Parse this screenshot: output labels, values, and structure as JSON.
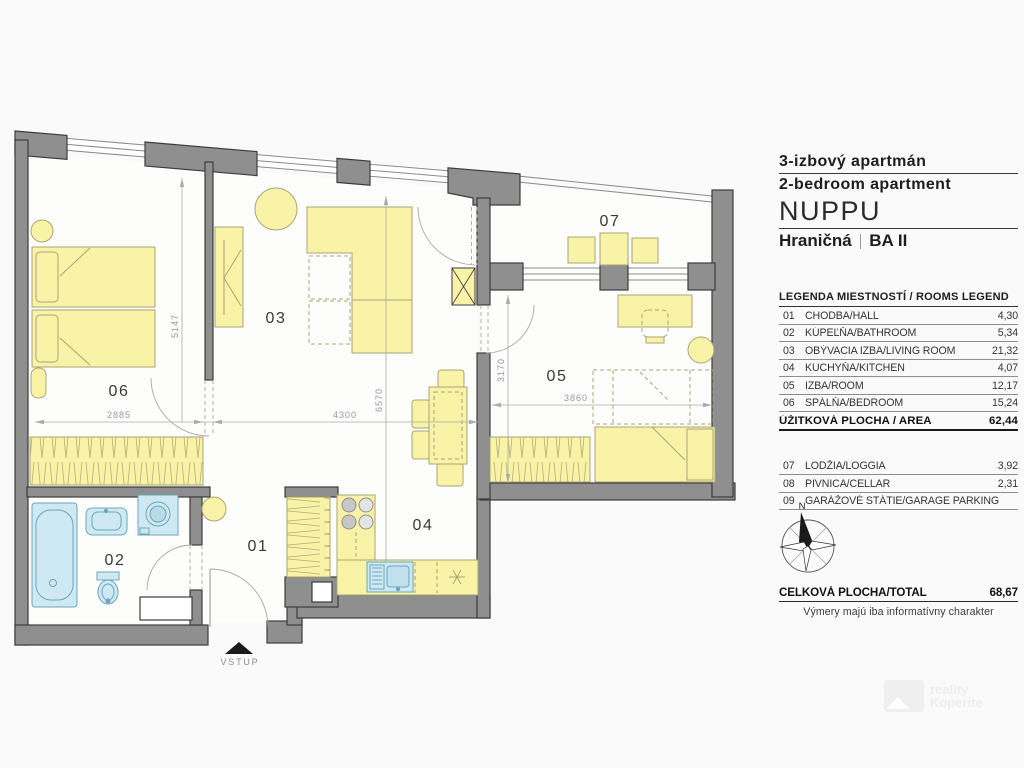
{
  "header": {
    "title_sk": "3-izbový apartmán",
    "title_en": "2-bedroom apartment",
    "project": "NUPPU",
    "location": "Hraničná",
    "city": "BA II"
  },
  "legend": {
    "title": "LEGENDA MIESTNOSTÍ / ROOMS LEGEND",
    "rooms": [
      {
        "num": "01",
        "name": "CHODBA/HALL",
        "area": "4,30"
      },
      {
        "num": "02",
        "name": "KÚPEĽŇA/BATHROOM",
        "area": "5,34"
      },
      {
        "num": "03",
        "name": "OBÝVACIA IZBA/LIVING ROOM",
        "area": "21,32"
      },
      {
        "num": "04",
        "name": "KUCHYŇA/KITCHEN",
        "area": "4,07"
      },
      {
        "num": "05",
        "name": "IZBA/ROOM",
        "area": "12,17"
      },
      {
        "num": "06",
        "name": "SPÁLŇA/BEDROOM",
        "area": "15,24"
      }
    ],
    "subtotal": {
      "label": "ÚŽITKOVÁ PLOCHA / AREA",
      "value": "62,44"
    },
    "extras": [
      {
        "num": "07",
        "name": "LODŽIA/LOGGIA",
        "area": "3,92"
      },
      {
        "num": "08",
        "name": "PIVNICA/CELLAR",
        "area": "2,31"
      },
      {
        "num": "09",
        "name": "GARÁŽOVÉ STÁTIE/GARAGE PARKING",
        "area": ""
      }
    ],
    "total": {
      "label": "CELKOVÁ PLOCHA/TOTAL",
      "value": "68,67"
    },
    "note": "Výmery majú iba informatívny charakter"
  },
  "plan": {
    "room_labels": {
      "r01": "01",
      "r02": "02",
      "r03": "03",
      "r04": "04",
      "r05": "05",
      "r06": "06",
      "r07": "07"
    },
    "dimensions": {
      "d5147": "5147",
      "d2885": "2885",
      "d4300": "4300",
      "d6570": "6570",
      "d3170": "3170",
      "d3860": "3860"
    },
    "entrance_label": "VSTUP",
    "compass_north": "N"
  },
  "watermark": {
    "line1": "reality",
    "line2": "Koperite"
  },
  "colors": {
    "wall": "#8f8f8f",
    "wall_outline": "#3c3c3c",
    "furniture": "#f8f3a6",
    "fixture_blue": "#cfe9f2",
    "background": "#fafafa"
  }
}
